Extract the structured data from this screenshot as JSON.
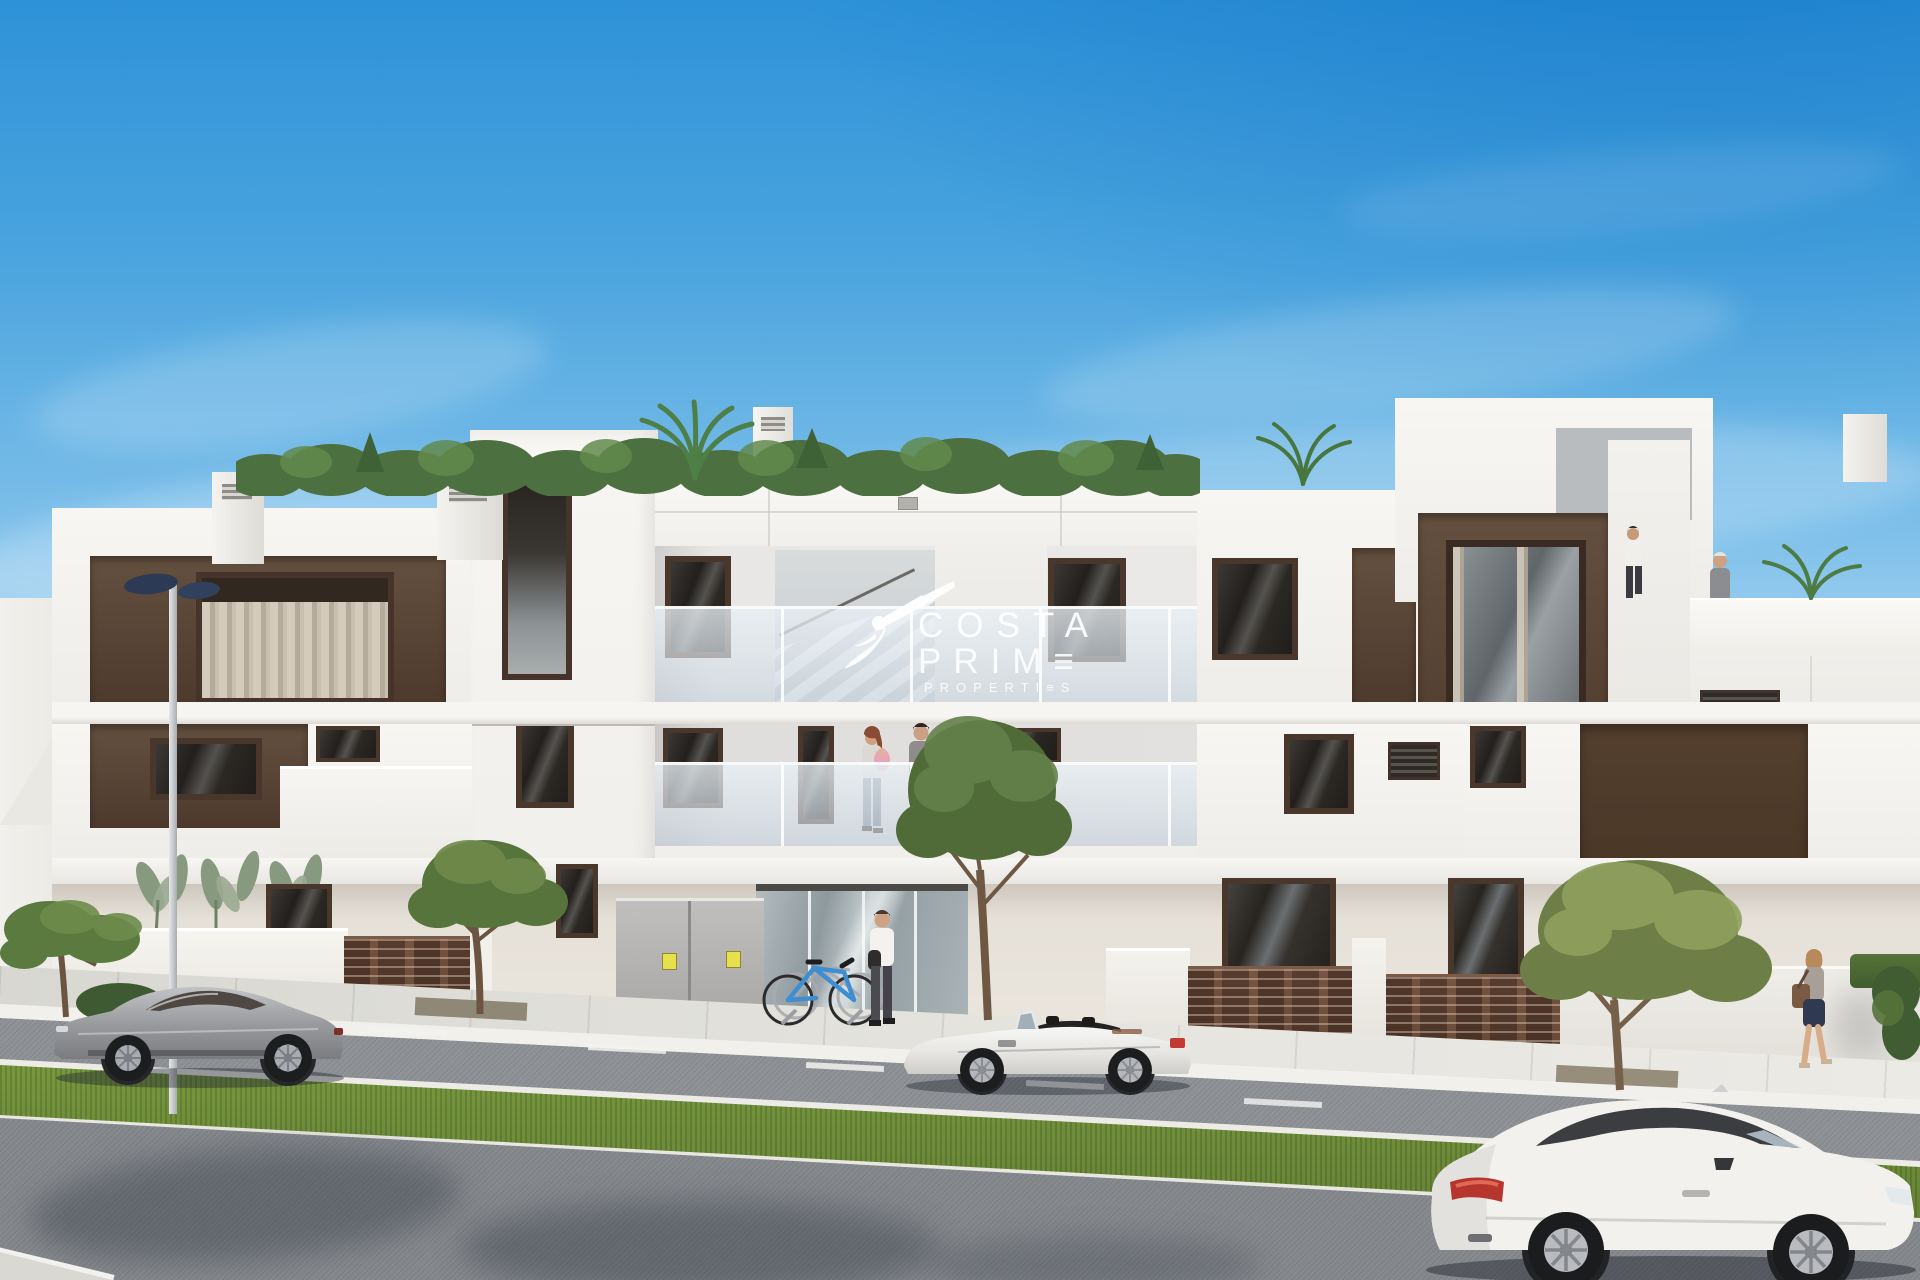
{
  "watermark": {
    "brand": "Costa Prime Properties",
    "icon": "hummingbird-icon",
    "line1": "COSTA",
    "line2": "PRIM≡",
    "line3": "PROPERTI≡S",
    "color": "#ffffff"
  },
  "palette": {
    "sky_top": "#1f87d3",
    "sky_mid": "#7fc0ea",
    "sky_horizon": "#eef7fc",
    "facade_white": "#f6f5f2",
    "facade_shade": "#e2e0db",
    "panel_brown": "#5d4738",
    "window_frame_brown": "#4a372b",
    "window_glass_dark": "#27231f",
    "glass_balustrade": "#dbe4ea",
    "fence_brown": "#6b4a39",
    "sidewalk_gray": "#dddcd6",
    "road_gray": "#8a8d91",
    "grass_green": "#6e8f3f",
    "tree_green": "#5f7d43",
    "tree_yellow_green": "#7e9052",
    "car_gray": "#9b9c9f",
    "car_white": "#f2f1ef",
    "taillight_red": "#c2372f",
    "bike_blue": "#3f8ed2",
    "lamp_navy": "#2c3a55",
    "sticker_yellow": "#e6df4e"
  },
  "scene": {
    "description": "3D exterior render of a modern white two-storey apartment building with rooftop terraces, brown accent panels and fences, street with parked cars, trees and pedestrians under a clear blue sky",
    "vehicles": [
      {
        "name": "gray-sports-coupe",
        "color": "#9b9c9f",
        "facing": "left"
      },
      {
        "name": "white-convertible",
        "color": "#f2f1ef",
        "facing": "left"
      },
      {
        "name": "white-coupe-foreground",
        "color": "#f4f3f1",
        "facing": "right"
      }
    ],
    "people": [
      {
        "name": "man-at-entrance"
      },
      {
        "name": "woman-with-baby-on-balcony"
      },
      {
        "name": "man-on-balcony"
      },
      {
        "name": "man-on-roof-terrace"
      },
      {
        "name": "woman-on-roof-terrace"
      },
      {
        "name": "woman-walking-sidewalk"
      }
    ],
    "objects": [
      {
        "name": "blue-bicycle"
      },
      {
        "name": "bike-rack"
      },
      {
        "name": "street-lamp"
      },
      {
        "name": "utility-cabinet",
        "stickers": 2
      },
      {
        "name": "rooftop-hedge"
      },
      {
        "name": "palm-plants"
      }
    ]
  }
}
